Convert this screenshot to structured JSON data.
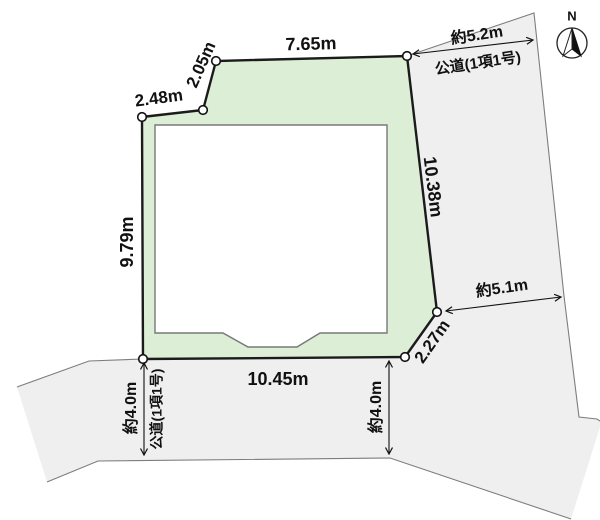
{
  "diagram_title": "land-plot-survey",
  "lot": {
    "fill": "#dceed6",
    "outline": "#1b1b1b",
    "dimensions": {
      "top": "7.65m",
      "upper_left_diagonal": "2.05m",
      "upper_left": "2.48m",
      "left": "9.79m",
      "right": "10.38m",
      "corner_cut": "2.27m",
      "bottom": "10.45m"
    }
  },
  "building": {
    "fill": "#ffffff"
  },
  "roads": {
    "fill": "#efefef",
    "east": {
      "width": "約5.2m",
      "name": "公道(1項1号)"
    },
    "southeast": {
      "width": "約5.1m"
    },
    "southwest": {
      "width": "約4.0m",
      "name": "公道(1項1号)"
    },
    "south": {
      "width": "約4.0m"
    }
  },
  "compass": {
    "label": "N"
  }
}
